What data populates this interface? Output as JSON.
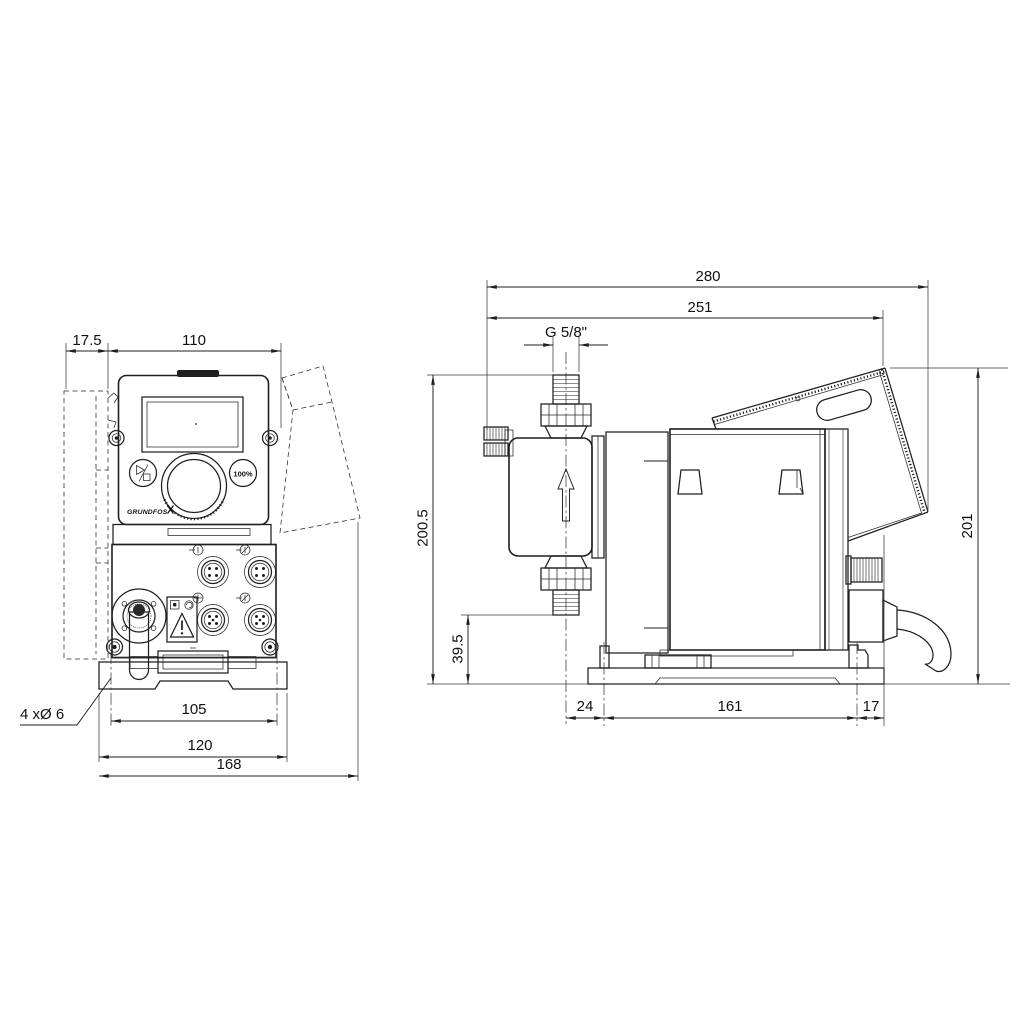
{
  "drawing": {
    "front_view": {
      "dims": {
        "wall_offset": "17.5",
        "panel_width": "110",
        "hole_note": "4 xØ 6",
        "hole_spacing": "105",
        "plate_width": "120",
        "overall_depth": "168"
      },
      "controls": {
        "brand": "GRUNDFOS",
        "button_100": "100%"
      }
    },
    "side_view": {
      "dims": {
        "overall_length": "280",
        "length_to_hood": "251",
        "thread": "G 5/8\"",
        "height_left": "200.5",
        "valve_height": "39.5",
        "height_right": "201",
        "foot_offset": "24",
        "hole_spacing": "161",
        "rear_clearance": "17"
      }
    }
  },
  "colors": {
    "line": "#1f1f1f",
    "background": "#ffffff"
  }
}
